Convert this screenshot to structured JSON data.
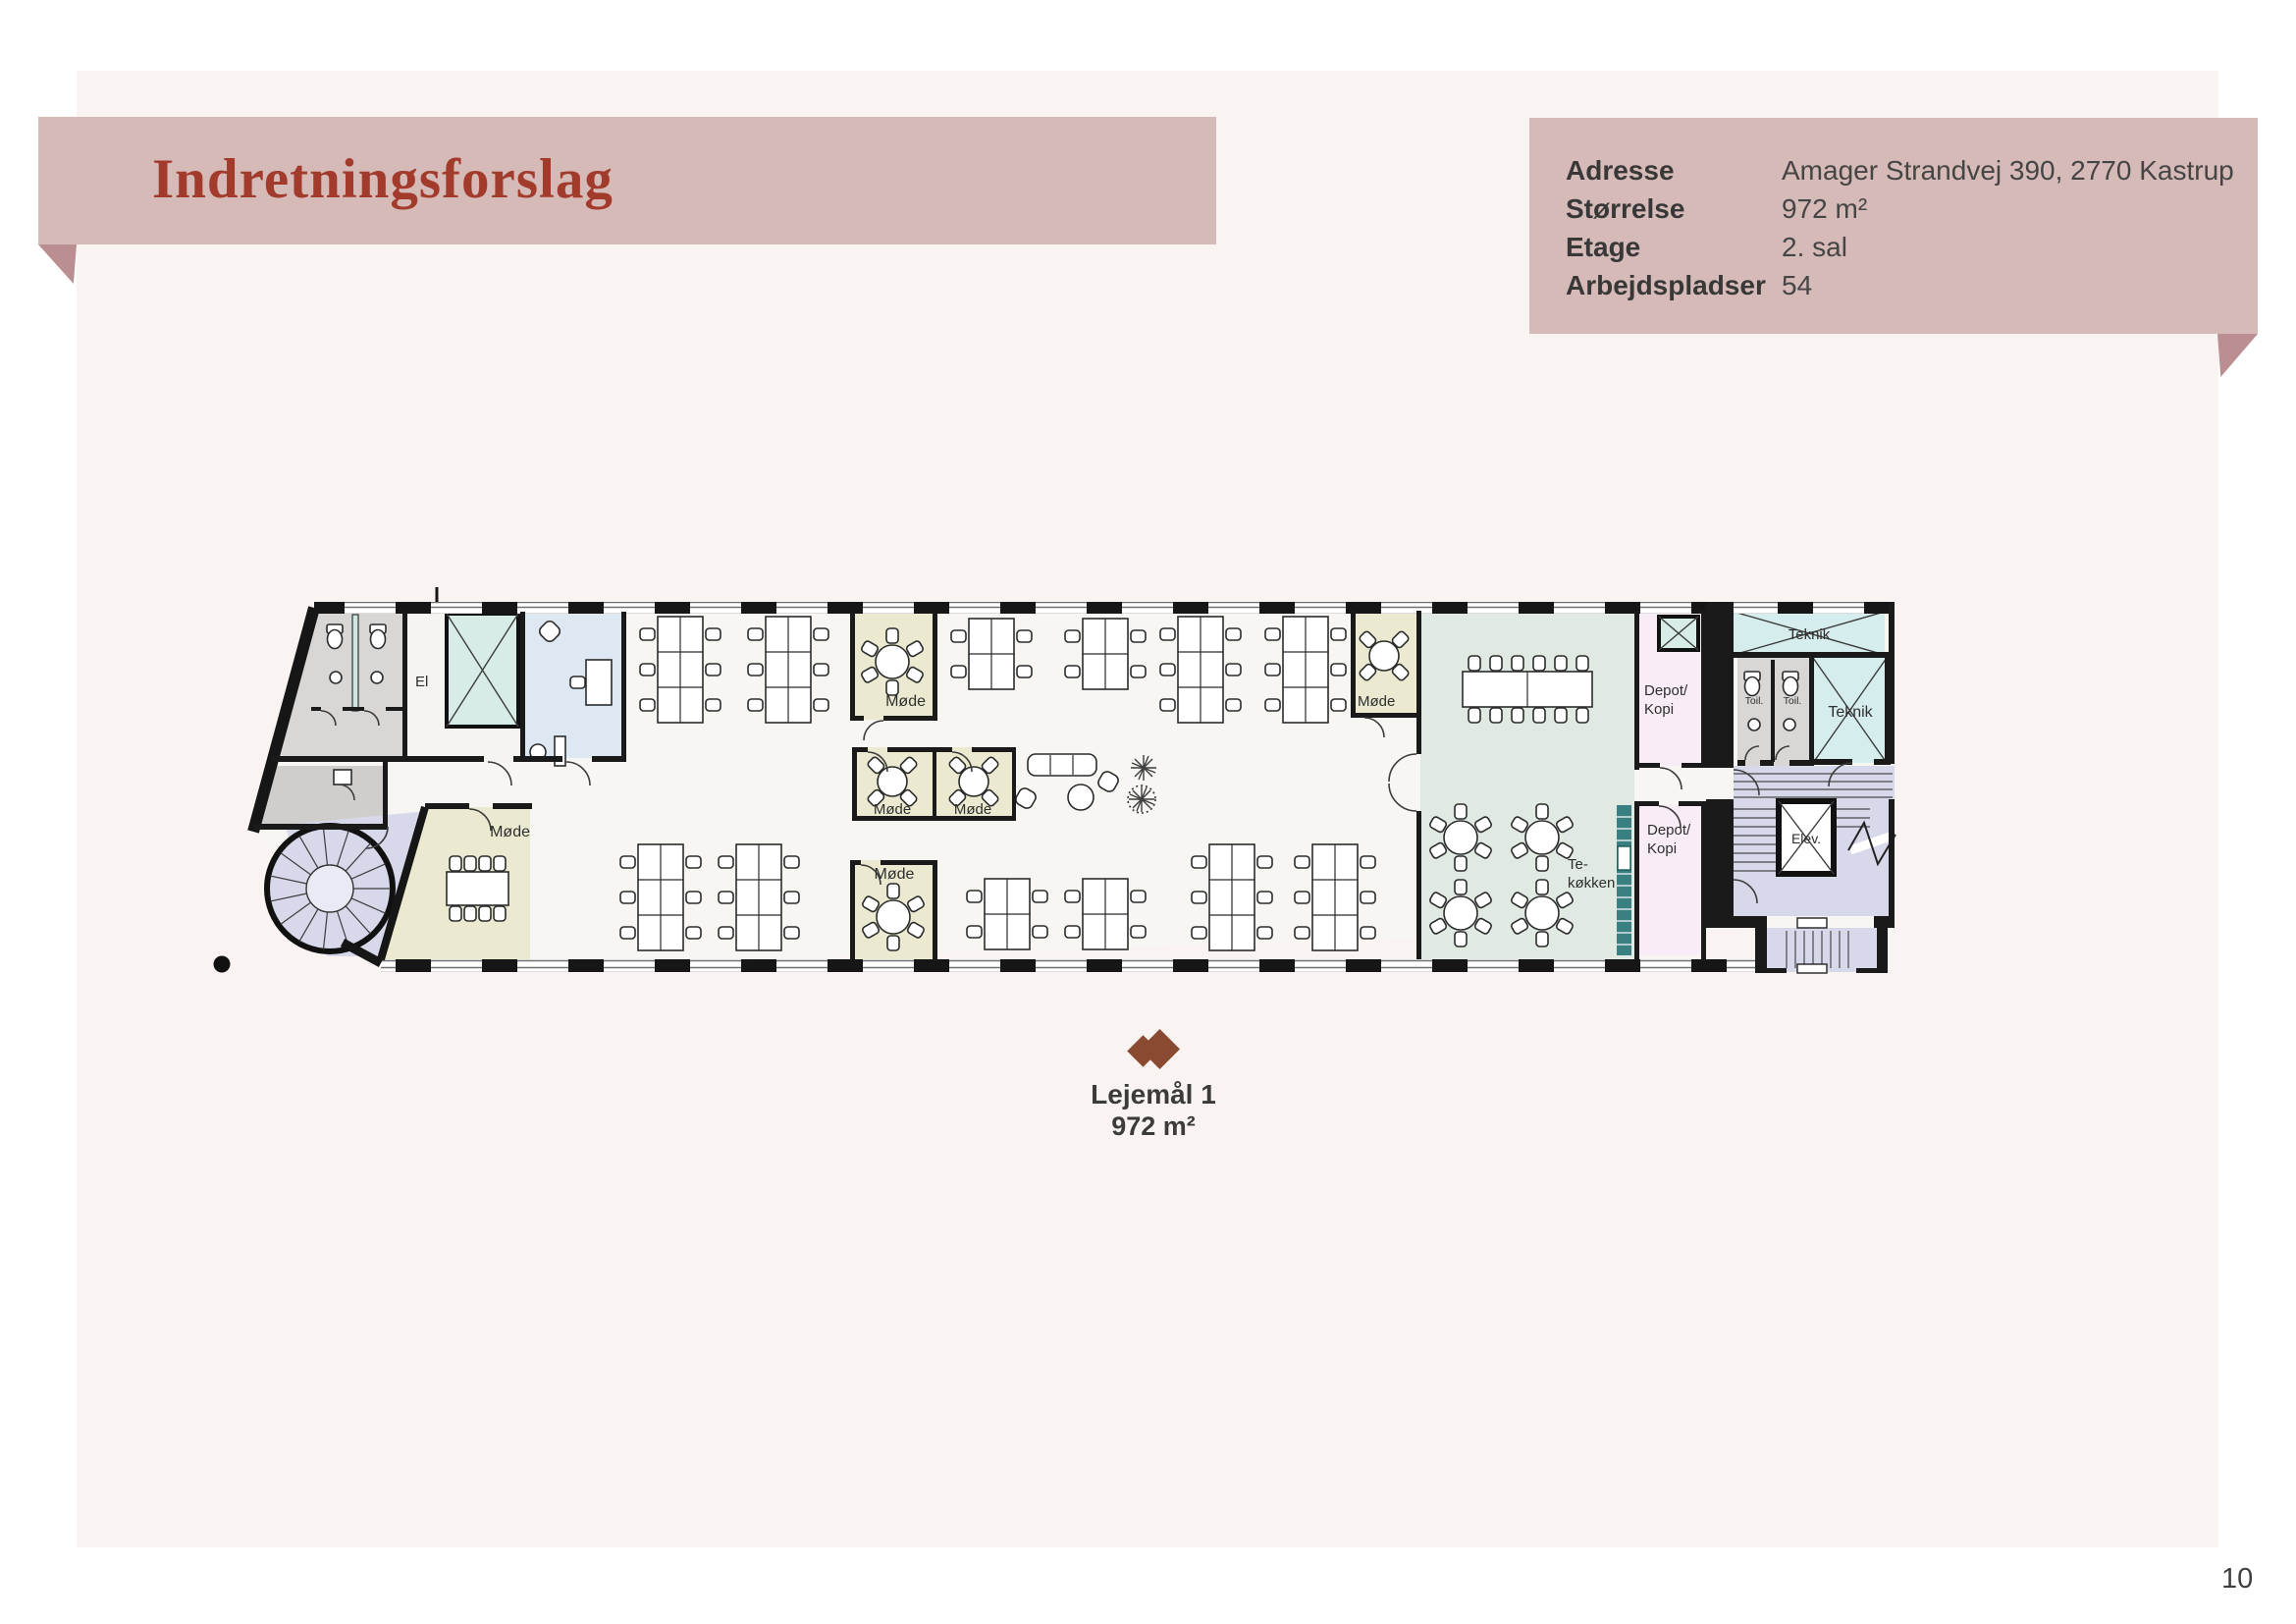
{
  "banner": {
    "title": "Indretningsforslag"
  },
  "info_box": {
    "rows": [
      {
        "label": "Adresse",
        "value": "Amager Strandvej 390, 2770 Kastrup"
      },
      {
        "label": "Størrelse",
        "value": "972 m²"
      },
      {
        "label": "Etage",
        "value": "2. sal"
      },
      {
        "label": "Arbejdspladser",
        "value": "54"
      }
    ]
  },
  "floor_plan": {
    "room_labels": {
      "el": "El",
      "meeting": "Møde",
      "tea_kitchen_line1": "Te-",
      "tea_kitchen_line2": "køkken",
      "depot_line1": "Depot/",
      "depot_line2": "Kopi",
      "technical": "Teknik",
      "toilet": "Toil.",
      "elevator": "Elev."
    }
  },
  "lease_label": {
    "name": "Lejemål 1",
    "area": "972 m²"
  },
  "footer": {
    "page_number": "10"
  },
  "colors": {
    "banner_pink": "#d6bab7",
    "fold_dark": "#bb8f91",
    "title_red": "#a23b2c",
    "panel_cream": "#f9f4f1",
    "text_dark": "#3b3b3b",
    "logo_brown": "#8a4a31"
  }
}
